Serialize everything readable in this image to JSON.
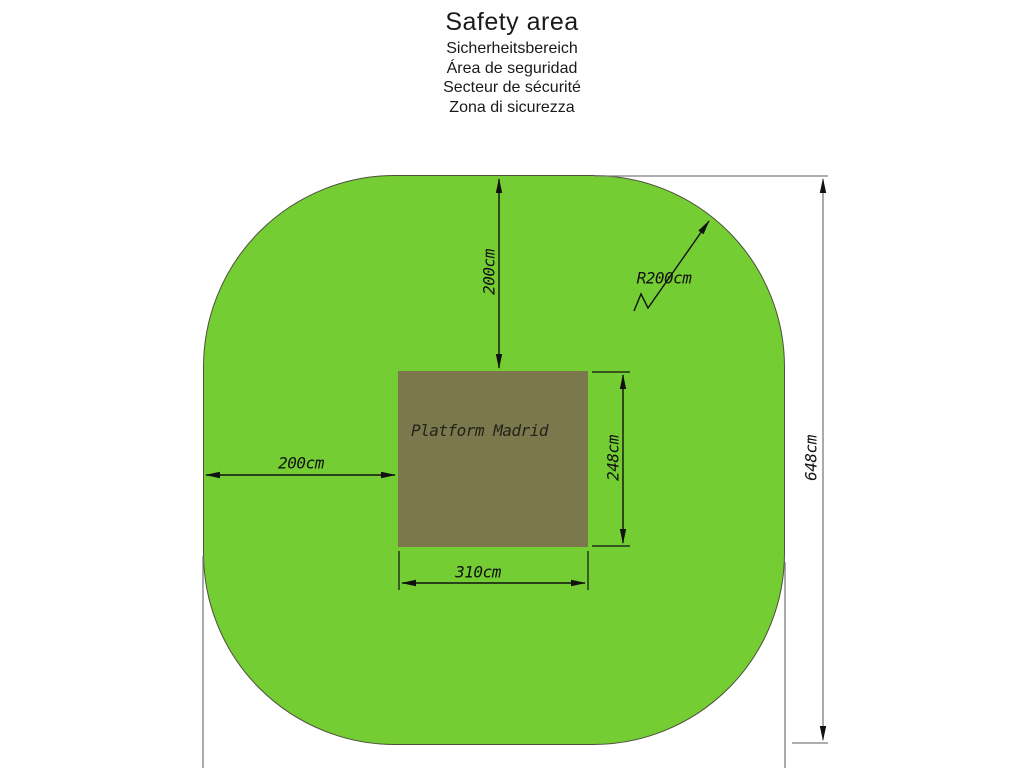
{
  "title": {
    "main": "Safety area",
    "translations": [
      "Sicherheitsbereich",
      "Área de seguridad",
      "Secteur de sécurité",
      "Zona di sicurezza"
    ]
  },
  "diagram": {
    "platform_label": "Platform Madrid",
    "dimensions": {
      "top_clearance": "200cm",
      "left_clearance": "200cm",
      "corner_radius": "R200cm",
      "platform_depth": "248cm",
      "platform_width": "310cm",
      "overall_height": "648cm"
    },
    "colors": {
      "safety_area_green": "#74cd32",
      "platform_olive": "#7b784d",
      "dimension_line": "#111111",
      "reference_line": "#7d7d7d"
    }
  }
}
